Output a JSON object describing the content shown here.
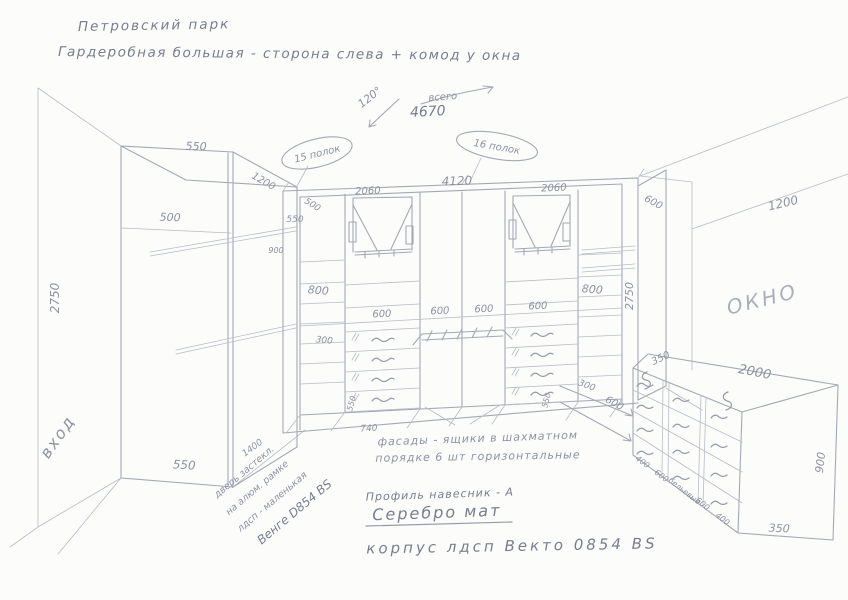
{
  "title": {
    "line1": "Петровский парк",
    "line2": "Гардеробная большая - сторона слева + комод у окна"
  },
  "top_note": {
    "angle": "120°",
    "total_label": "всего",
    "total_value": "4670"
  },
  "callouts": {
    "left_oval": "15 полок",
    "right_oval": "16 полок"
  },
  "room": {
    "entrance": "вход",
    "window": "ОКНО",
    "window_wall_width": "1200"
  },
  "left_wardrobe": {
    "top_depth": "550",
    "shelf_depth": "500",
    "height": "2750",
    "bottom_width": "550",
    "corner_diag": "1200",
    "floor_gap": "1400"
  },
  "wall_unit": {
    "total_width": "4120",
    "left_section": "2060",
    "right_section": "2060",
    "return_depth": "550",
    "return_diag": "500",
    "rod_mark": "900",
    "left_col_gap": "800",
    "left_shelf_gap": "300",
    "right_col_gap": "800",
    "col_widths": [
      "600",
      "600",
      "600",
      "600"
    ],
    "plinth_left": "550",
    "plinth_right": "550",
    "floor_depth": "740",
    "height": "2750",
    "right_return_depth": "600",
    "dresser_gap_small": "300",
    "dresser_gap": "600"
  },
  "dresser": {
    "top_depth": "350",
    "length": "2000",
    "height": "900",
    "bottom_depth": "350",
    "bottom_labels": [
      "400",
      "600",
      "бельевые",
      "600",
      "400"
    ]
  },
  "notes": {
    "fronts_line1": "фасады - ящики в шахматном",
    "fronts_line2": "порядке 6 шт горизонтальные",
    "door_line1": "дверь застекл.",
    "door_line2": "на алюм. рамке",
    "door_line3": "лдсп - маленькая",
    "door_line4": "Венге D854 BS",
    "profile": "Профиль навесник - А",
    "finish": "Серебро мат",
    "body": "корпус лдсп Векто 0854 BS"
  }
}
